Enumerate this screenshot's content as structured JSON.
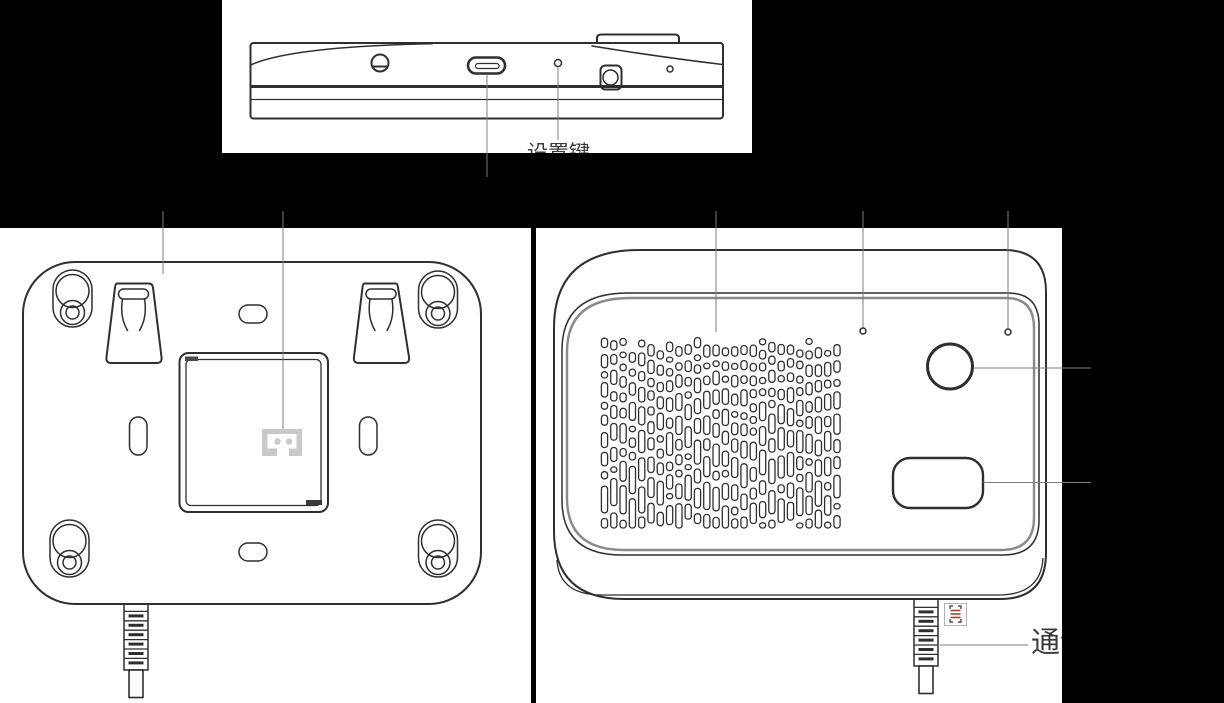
{
  "window": {
    "background": "#000000"
  },
  "figure": {
    "panel_background": "#ffffff",
    "line_color": "#2f2f2f",
    "leader_color": "#7d7d7d",
    "text_color": "#3a3a3a",
    "connector_fill": "#c9c9c9",
    "scan_icon": {
      "border": "#b5b5b5",
      "glyph_red": "#9c4632",
      "glyph_dark": "#4f4f4f"
    },
    "views": {
      "top": {
        "label": "设置键"
      },
      "back": {},
      "front": {
        "label": "通讯"
      }
    }
  }
}
